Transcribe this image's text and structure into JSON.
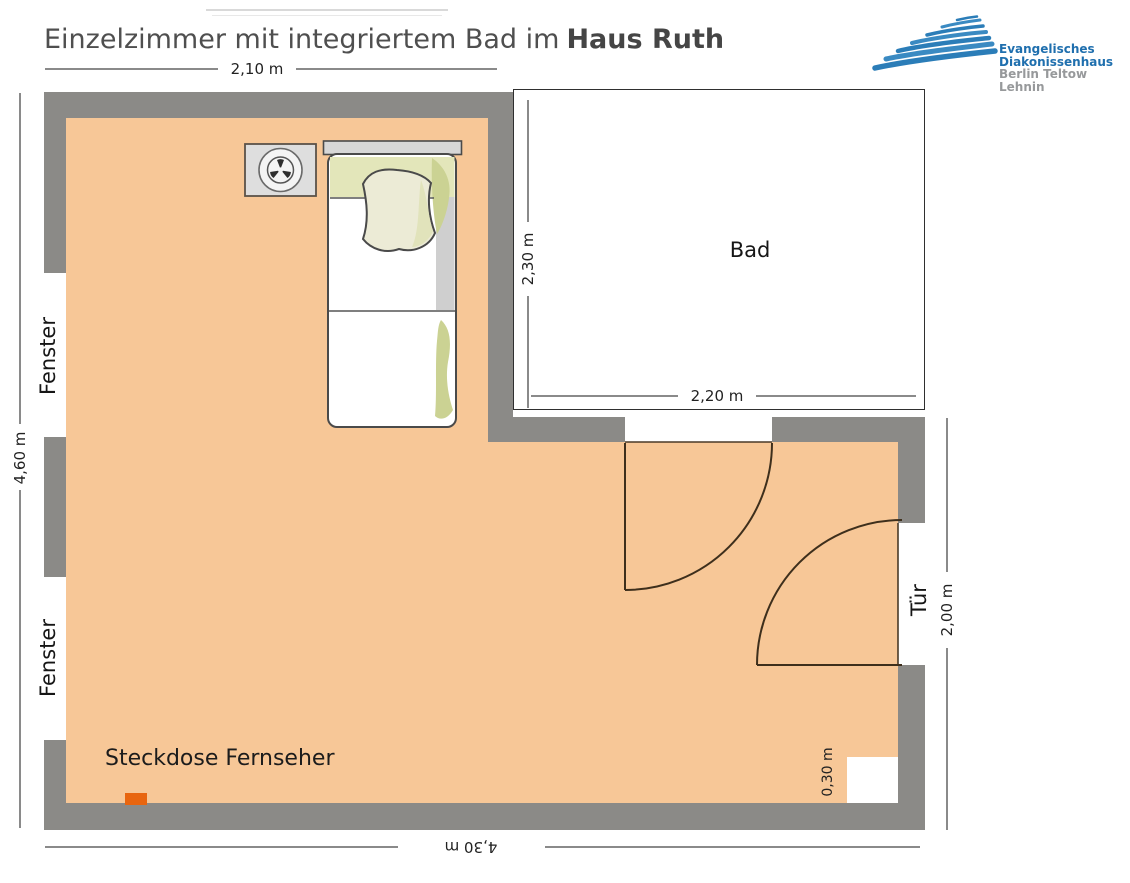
{
  "title": {
    "prefix": "Einzelzimmer mit integriertem Bad im",
    "emphasis": "Haus Ruth"
  },
  "logo": {
    "name_line1": "Evangelisches",
    "name_line2": "Diakonissenhaus",
    "name_line3": "Berlin Teltow Lehnin",
    "brand_blue": "#2b7db8",
    "brand_gray": "#97999b"
  },
  "plan": {
    "room_labels": {
      "bathroom": "Bad",
      "window": "Fenster",
      "door": "Tür"
    },
    "annotations": {
      "tv_socket": "Steckdose Fernseher"
    },
    "dimensions": {
      "room_width_top": "2,10 m",
      "room_height_left": "4,60 m",
      "room_width_bottom": "4,30 m",
      "door_wall_height": "2,00 m",
      "bath_height": "2,30 m",
      "bath_width": "2,20 m",
      "niche_width": "0,30 m"
    },
    "colors": {
      "floor": "#f7c797",
      "wall": "#8b8a87",
      "socket": "#e8650f",
      "dim_line": "#8a8a8a",
      "bed_green": "#cbd293",
      "bed_gray": "#cfcfcf"
    }
  }
}
